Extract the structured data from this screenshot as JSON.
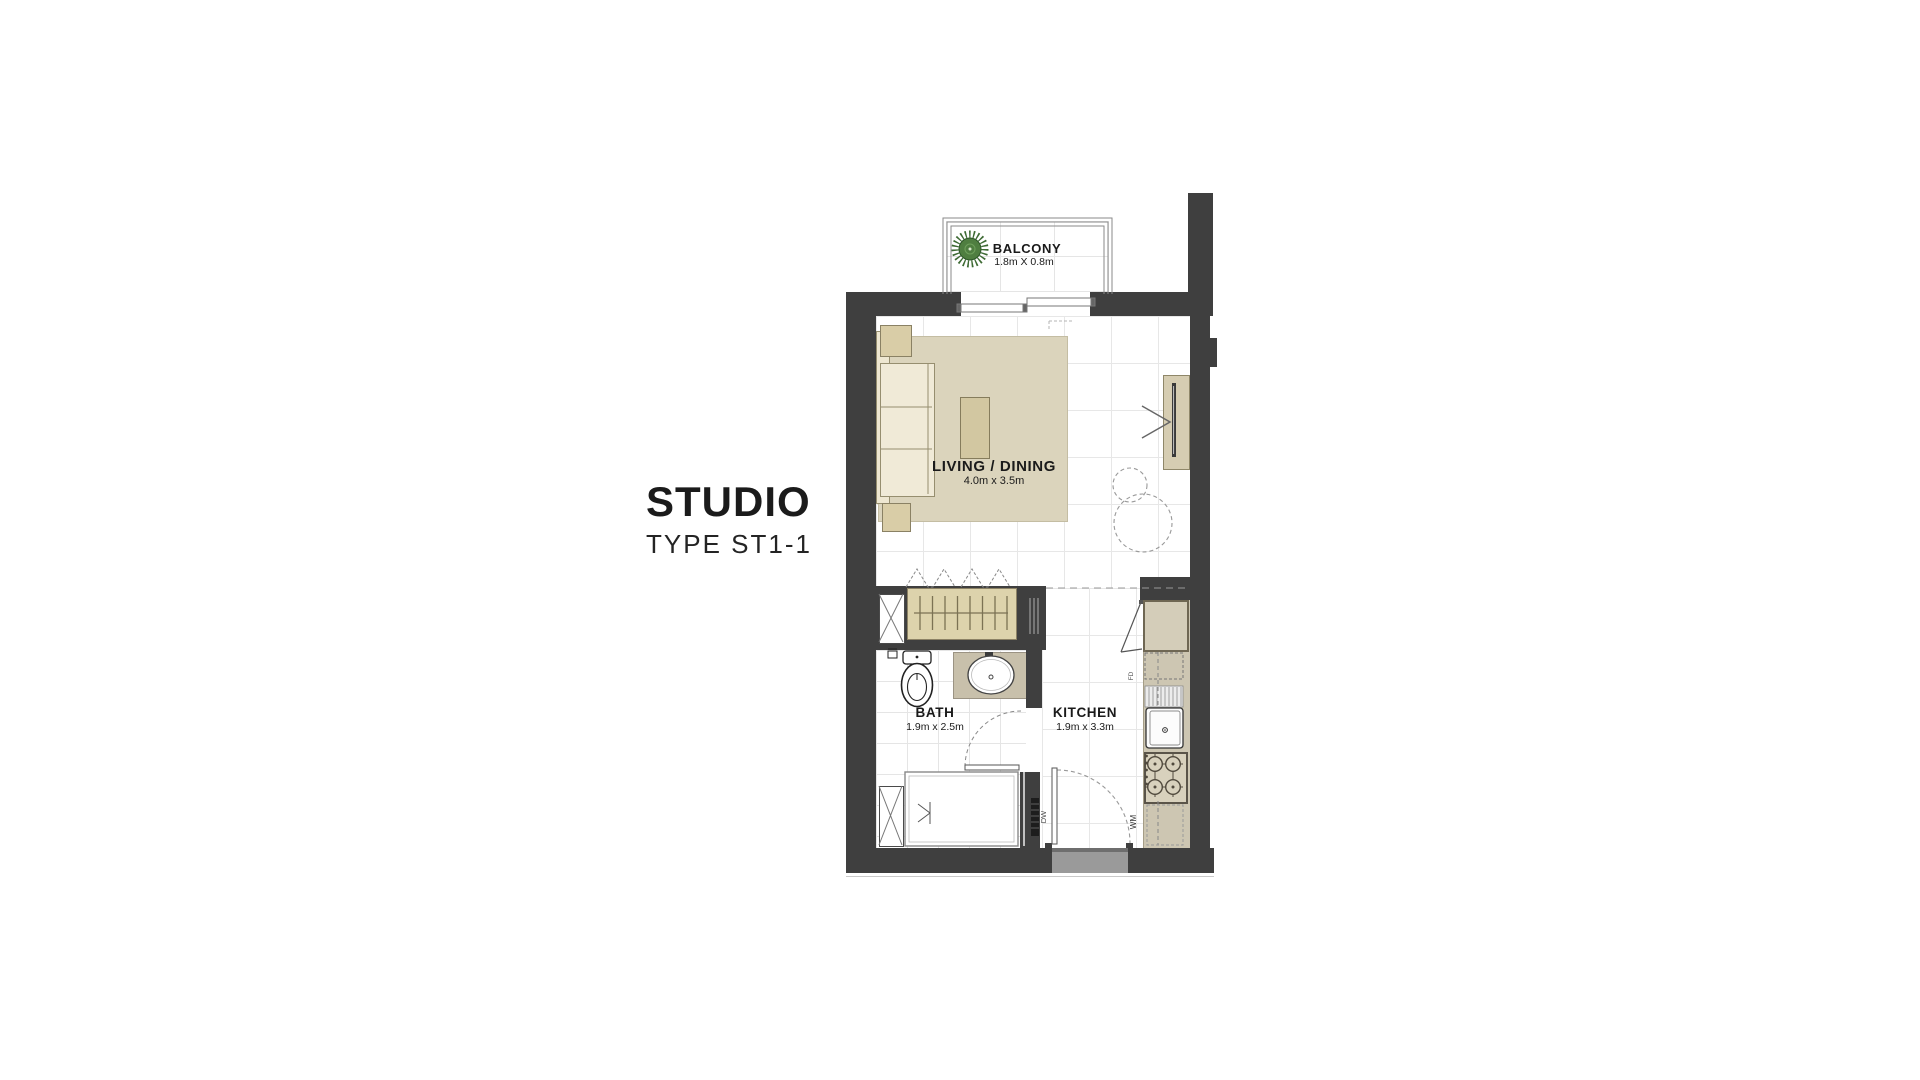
{
  "title": {
    "main": "STUDIO",
    "subtitle": "TYPE ST1-1"
  },
  "rooms": {
    "balcony": {
      "name": "BALCONY",
      "dimensions": "1.8m X 0.8m"
    },
    "living_dining": {
      "name": "LIVING / DINING",
      "dimensions": "4.0m x 3.5m"
    },
    "bath": {
      "name": "BATH",
      "dimensions": "1.9m x 2.5m"
    },
    "kitchen": {
      "name": "KITCHEN",
      "dimensions": "1.9m x 3.3m"
    }
  },
  "appliance_labels": {
    "washing_machine": "WM",
    "dishwasher": "DW",
    "floor_drain": "FD"
  },
  "colors": {
    "wall": "#3f3f3f",
    "rug": "#dbd4bc",
    "sofa": "#f0ead7",
    "furniture": "#d2c7a1",
    "kitchen_counter": "#cdc6b2",
    "wardrobe": "#ddd3ac",
    "plant_green": "#4f7e40",
    "floor_grid": "#e7e7e7",
    "dashed_lines": "#999999"
  }
}
